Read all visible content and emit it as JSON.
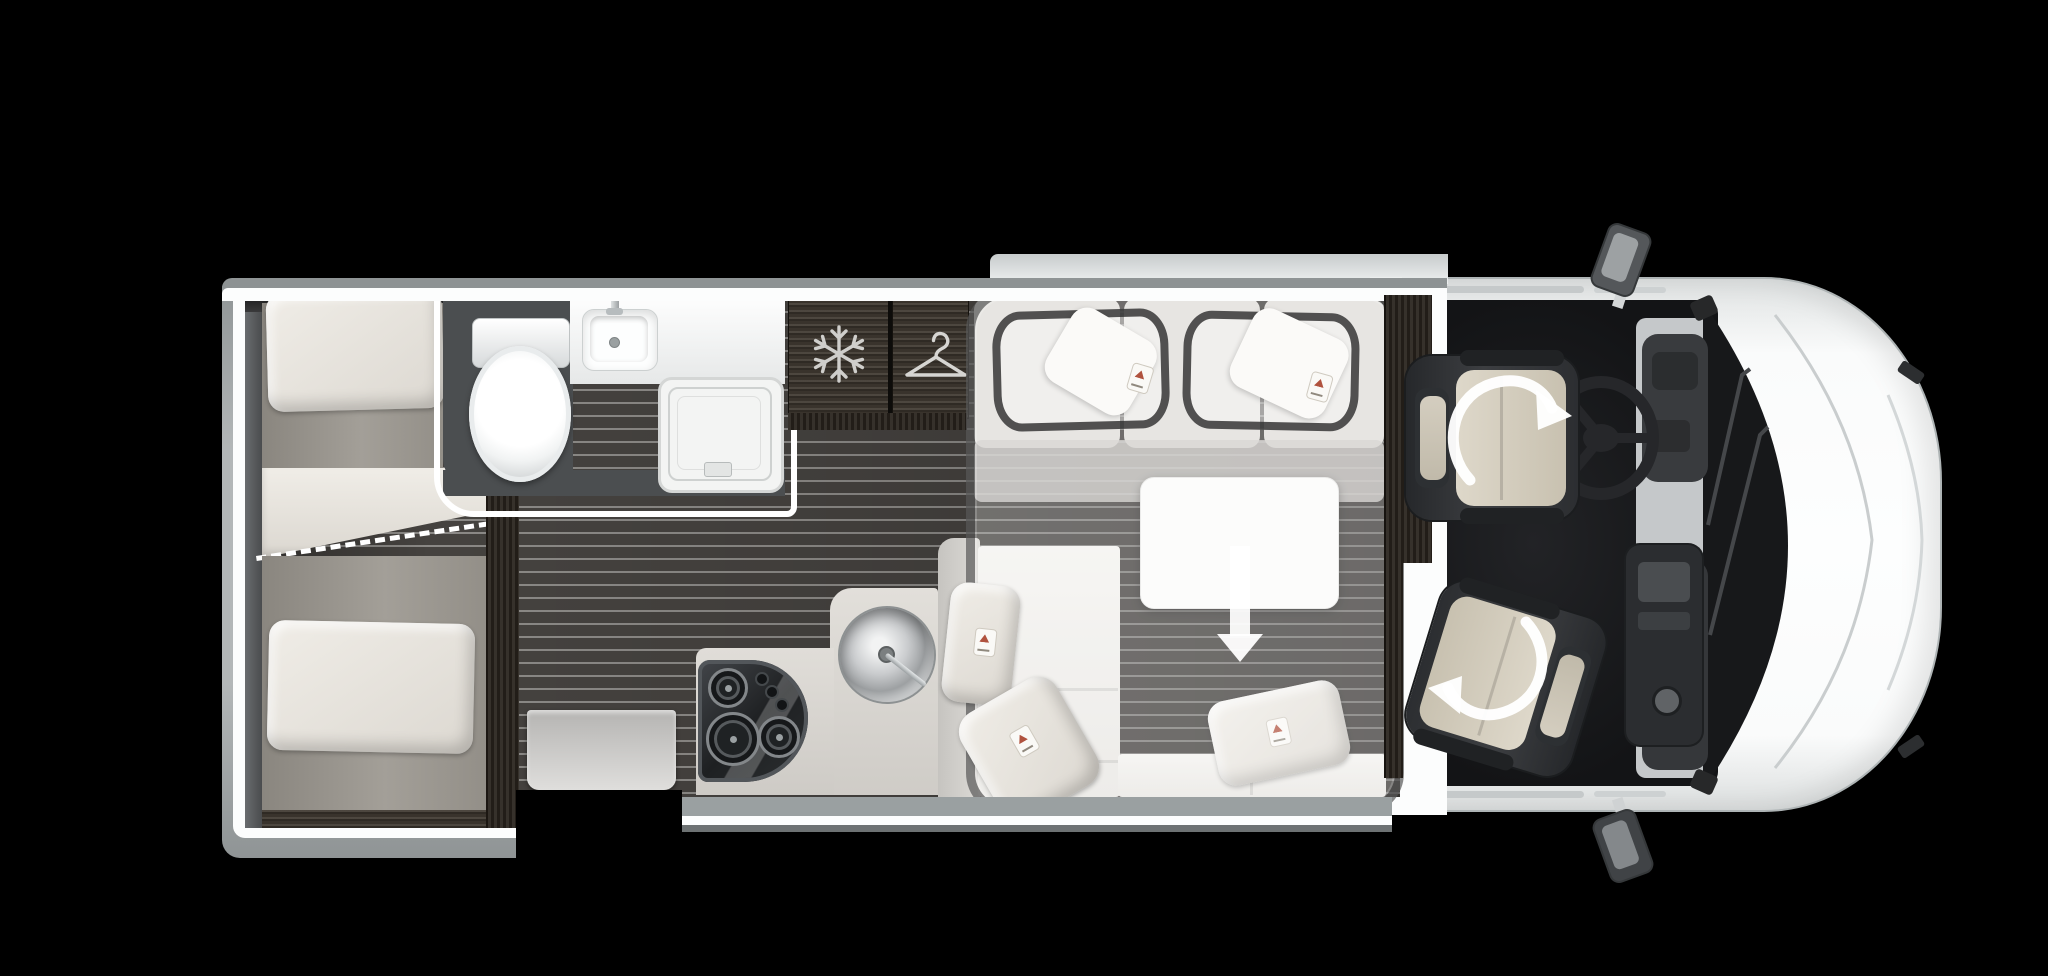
{
  "scene": {
    "type": "motorhome floor plan, top-down view",
    "background": "#000000",
    "vehicle_orientation": "rear of vehicle at left, driver cab and front at right",
    "text_visible": "none"
  },
  "areas": {
    "rear_bedroom": {
      "items": [
        {
          "name": "single-bed-top",
          "pillow": true
        },
        {
          "name": "single-bed-bottom",
          "pillow": true
        },
        {
          "name": "bed-conversion-duvet"
        },
        {
          "name": "bed-conversion-dashed-line",
          "style": "white dashed diagonal"
        }
      ]
    },
    "bathroom": {
      "items": [
        {
          "name": "toilet"
        },
        {
          "name": "washbasin",
          "has_faucet": true
        },
        {
          "name": "shower-tray"
        }
      ]
    },
    "tall_cabinets": {
      "items": [
        {
          "name": "fridge",
          "icon": "snowflake-icon"
        },
        {
          "name": "wardrobe",
          "icon": "hanger-icon"
        }
      ]
    },
    "kitchen": {
      "items": [
        {
          "name": "three-burner-hob",
          "burners": 3,
          "knobs": 3
        },
        {
          "name": "round-sink",
          "has_faucet": true
        },
        {
          "name": "worktop"
        }
      ]
    },
    "lounge": {
      "items": [
        {
          "name": "l-shaped-sofa"
        },
        {
          "name": "scatter-cushions",
          "count": 5
        },
        {
          "name": "table"
        },
        {
          "name": "drop-down-bed-overlay",
          "style": "translucent rounded rectangle with two dark-outlined pillows"
        },
        {
          "name": "drop-down-arrow",
          "meaning": "drop-down bed lowers over the lounge"
        }
      ]
    },
    "entrance": {
      "items": [
        {
          "name": "entry-step"
        },
        {
          "name": "door-opening"
        }
      ]
    },
    "cab": {
      "items": [
        {
          "name": "driver-seat",
          "swivel": true
        },
        {
          "name": "passenger-seat",
          "swivel": true
        },
        {
          "name": "swivel-rotation-arrows",
          "count": 2
        },
        {
          "name": "steering-wheel"
        },
        {
          "name": "dashboard"
        },
        {
          "name": "center-console"
        },
        {
          "name": "windshield",
          "wipers": 2
        },
        {
          "name": "wing-mirror-top"
        },
        {
          "name": "wing-mirror-bottom"
        }
      ]
    }
  },
  "icons": {
    "snowflake-icon": "fridge / freezer",
    "hanger-icon": "wardrobe",
    "rotate-arrow-icon": "seat swivels toward lounge",
    "down-arrow-icon": "drop-down bed direction"
  },
  "palette": {
    "background": "#000000",
    "body_white": "#f8fafa",
    "wall_gray": "#9aa0a1",
    "wall_white_line": "#fcfdfd",
    "floor_dark": "#44413e",
    "floor_stripe": "#8b8986",
    "furniture_wood_dark": "#39332c",
    "mattress_gray": "#968f88",
    "linen_white": "#eae7e1",
    "counter_beige": "#d9d6d1",
    "overlay_outline": "#3e3e3e",
    "cab_floor": "#17181a",
    "seat_dark": "#33363a",
    "seat_pad_beige": "#d6cfc0",
    "arrow_white": "#ffffff"
  }
}
